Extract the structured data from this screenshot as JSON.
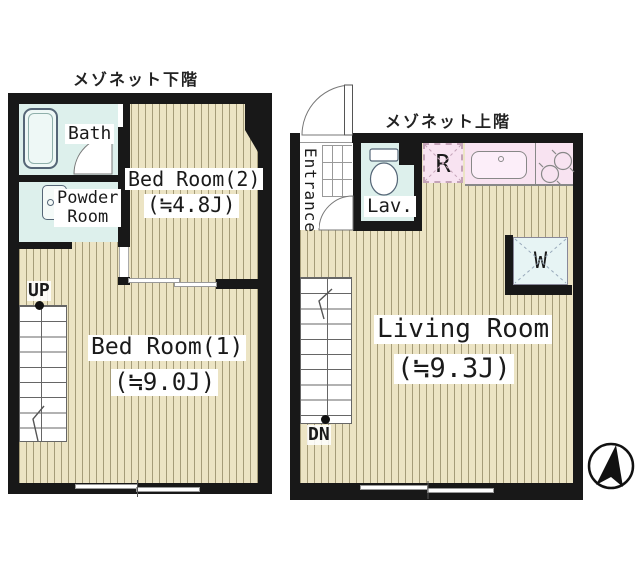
{
  "colors": {
    "wall": "#181818",
    "flooring": "#ece4c4",
    "flooring_stripe": "#a59c79",
    "wet_area": "#ddf0ec",
    "kitchen": "#f8e3f1",
    "washer_box": "#e7f4f4",
    "label_background": "#ffffff"
  },
  "plans": {
    "lower": {
      "title": "メゾネット下階",
      "labels": {
        "bath": "Bath",
        "powder_room_line1": "Powder",
        "powder_room_line2": "Room",
        "bedroom2_name": "Bed Room(2)",
        "bedroom2_size": "(≒4.8J)",
        "bedroom1_name": "Bed Room(1)",
        "bedroom1_size": "(≒9.0J)",
        "stairs": "UP"
      }
    },
    "upper": {
      "title": "メゾネット上階",
      "labels": {
        "entrance": "Entrance",
        "lavatory": "Lav.",
        "refrigerator": "R",
        "washer": "W",
        "living_name": "Living Room",
        "living_size": "(≒9.3J)",
        "stairs": "DN"
      }
    }
  }
}
